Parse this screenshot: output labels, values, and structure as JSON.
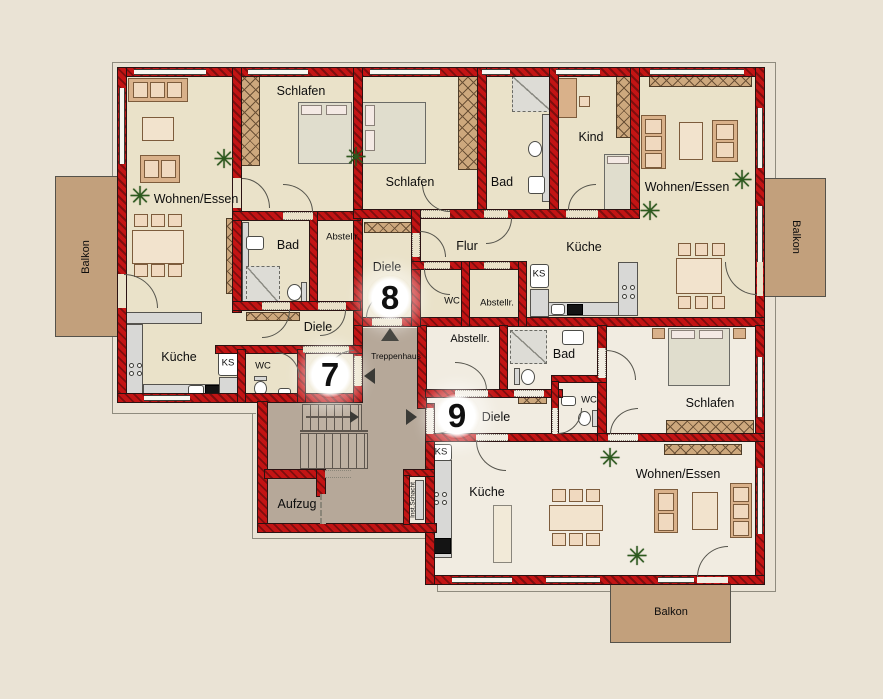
{
  "palette": {
    "background": "#eae3d5",
    "wall_red": "#c31414",
    "wall_red_dark": "#7e0e0e",
    "floor_beige": "#eae2c9",
    "floor_light": "#f1ece1",
    "stairwell_floor": "#b6a899",
    "balcony": "#c2a07c",
    "furniture_tan": "#d9b18a",
    "counter_gray": "#d8d8d6",
    "plant_green": "#2c5a1d"
  },
  "stairwell": {
    "treppenhaus": "Treppenhaus",
    "aufzug": "Aufzug",
    "inst_schacht": "Inst.Schacht"
  },
  "apt7": {
    "number": "7",
    "wohnen_essen": "Wohnen/Essen",
    "schlafen": "Schlafen",
    "bad": "Bad",
    "abstellraum": "Abstellr.",
    "diele": "Diele",
    "kueche": "Küche",
    "kuehlschrank": "KS",
    "wc": "WC",
    "balkon": "Balkon"
  },
  "apt8": {
    "number": "8",
    "schlafen": "Schlafen",
    "bad": "Bad",
    "kind": "Kind",
    "wohnen_essen": "Wohnen/Essen",
    "flur": "Flur",
    "kueche": "Küche",
    "kuehlschrank": "KS",
    "wc": "WC",
    "abstellraum": "Abstellr.",
    "diele": "Diele",
    "balkon": "Balkon"
  },
  "apt9": {
    "number": "9",
    "abstellraum": "Abstellr.",
    "bad": "Bad",
    "diele": "Diele",
    "wc": "WC",
    "kuehlschrank": "KS",
    "schlafen": "Schlafen",
    "wohnen_essen": "Wohnen/Essen",
    "kueche": "Küche",
    "balkon": "Balkon"
  }
}
